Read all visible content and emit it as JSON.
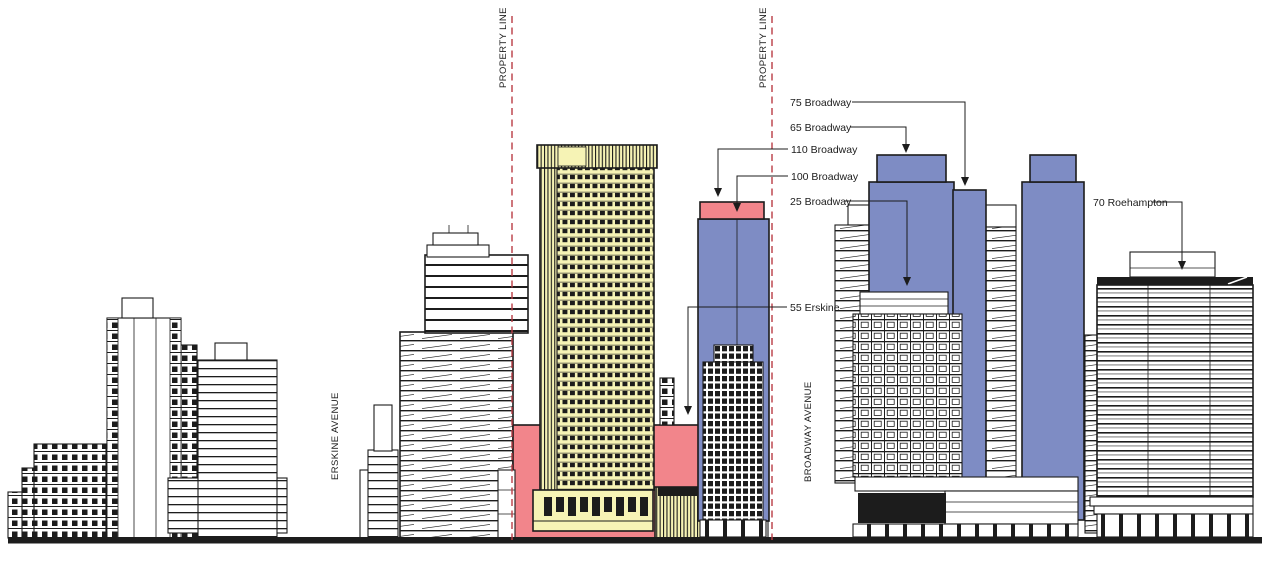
{
  "colors": {
    "proposed_blue": "#7e8cc4",
    "context_yellow": "#f6f3b5",
    "highlight_pink": "#f2858b",
    "property_line_red": "#ba3c44",
    "linework": "#1c1c1c",
    "background": "#ffffff"
  },
  "property_line_labels": [
    "PROPERTY LINE",
    "PROPERTY LINE"
  ],
  "street_labels": {
    "erskine": "ERSKINE AVENUE",
    "broadway": "BROADWAY AVENUE"
  },
  "building_labels": [
    {
      "name": "75-broadway",
      "label": "75 Broadway"
    },
    {
      "name": "65-broadway",
      "label": "65 Broadway"
    },
    {
      "name": "110-broadway",
      "label": "110 Broadway"
    },
    {
      "name": "100-broadway",
      "label": "100 Broadway"
    },
    {
      "name": "25-broadway",
      "label": "25 Broadway"
    },
    {
      "name": "55-erskine",
      "label": "55 Erskine"
    },
    {
      "name": "70-roehampton",
      "label": "70 Roehampton"
    }
  ]
}
